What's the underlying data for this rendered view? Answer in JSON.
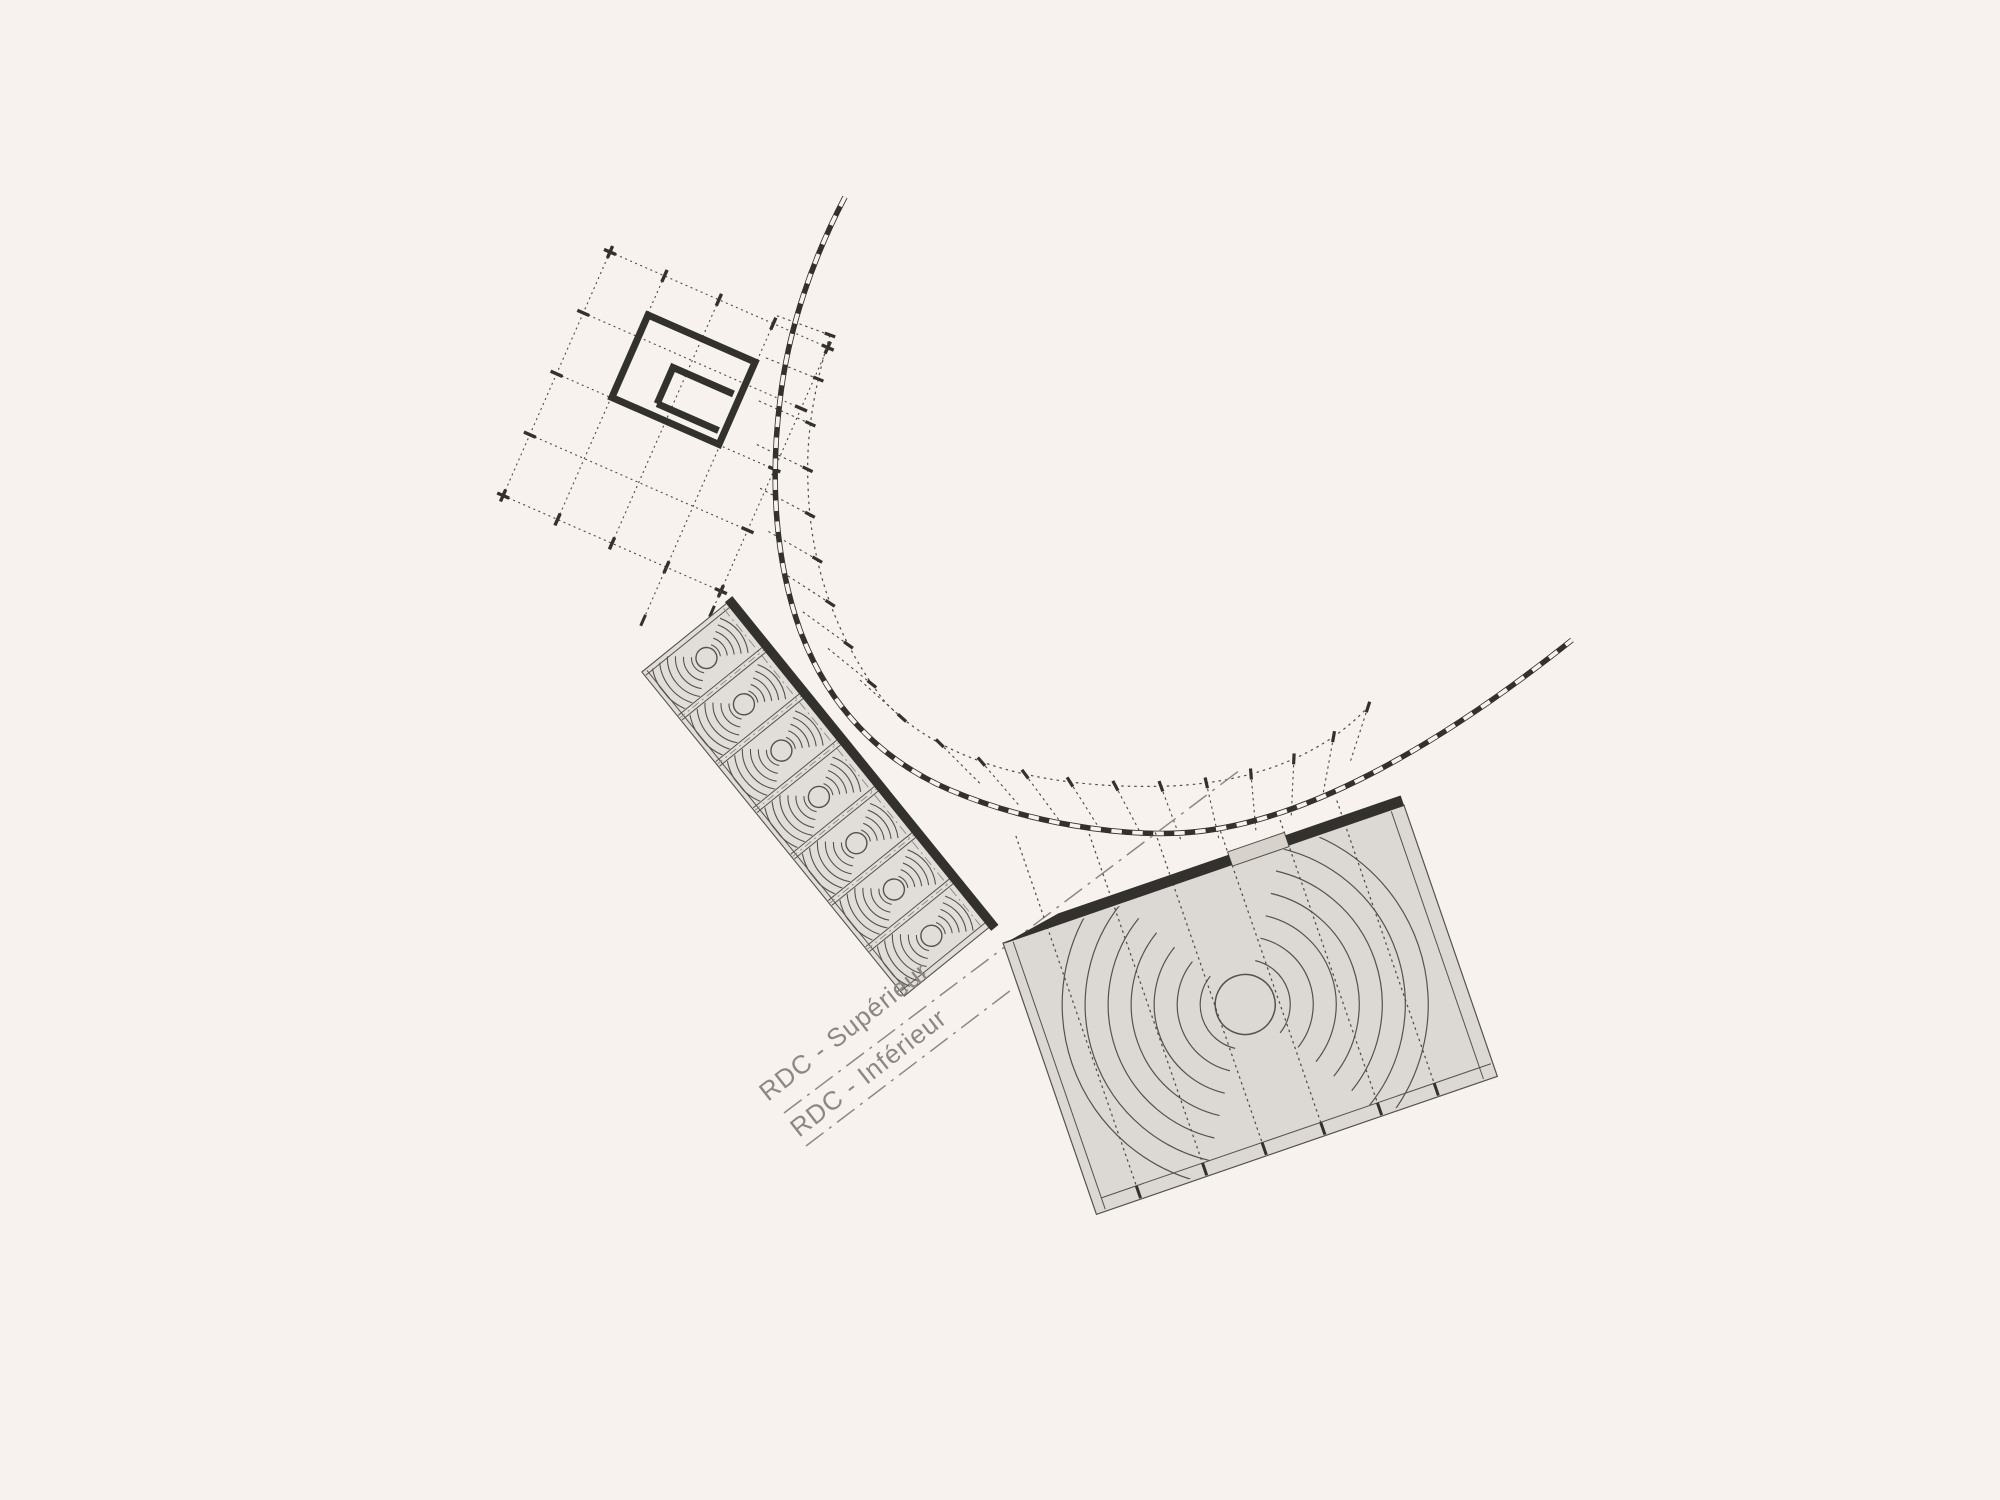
{
  "page": {
    "background": "#f7f2ed",
    "kind_note": "architectural site plan line drawing"
  },
  "labels": {
    "level_upper": "RDC - Supérieur",
    "level_lower": "RDC - Inférieur"
  },
  "colors": {
    "background": "#f7f2ed",
    "ink": "#33312d",
    "line": "#55524e",
    "grid": "#4c4a46",
    "faint": "#8b8884",
    "building_fill": "#dcd8d3",
    "strip_fill": "#e1ddd8",
    "patch_fill": "#d7d2cc",
    "text": "#8b8884"
  }
}
